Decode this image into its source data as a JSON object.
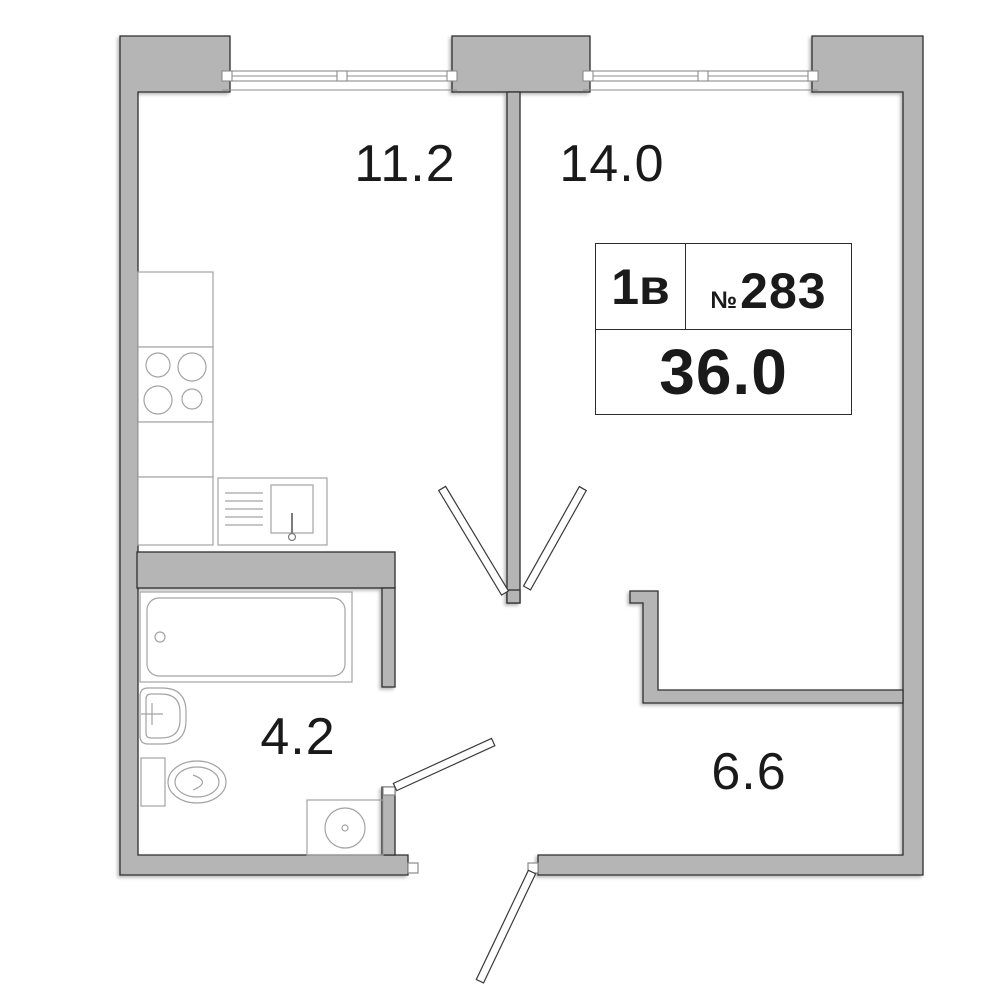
{
  "plan": {
    "title": "apartment-floor-plan",
    "info_box": {
      "flat_type": "1в",
      "number_sign": "№",
      "apartment_number": "283",
      "total_area": "36.0"
    },
    "rooms": [
      {
        "name": "kitchen",
        "area": "11.2"
      },
      {
        "name": "living-room",
        "area": "14.0"
      },
      {
        "name": "bathroom",
        "area": "4.2"
      },
      {
        "name": "hallway",
        "area": "6.6"
      }
    ],
    "colors": {
      "wall_fill": "#b5b5b5",
      "wall_outline": "#2f2f2f",
      "fixture_stroke": "#a3a3a3",
      "window_frame": "#8c8c8c",
      "text": "#1a1a1a",
      "background": "#ffffff"
    }
  }
}
